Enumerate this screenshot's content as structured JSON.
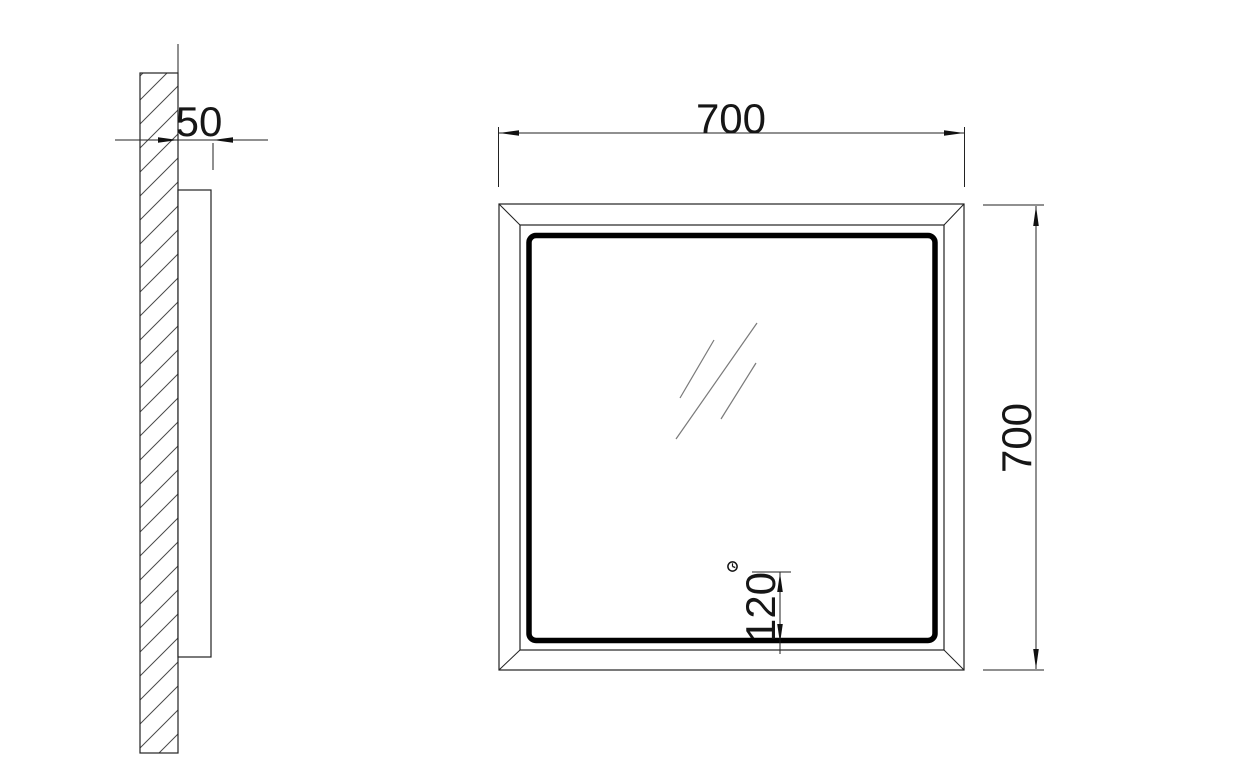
{
  "drawing": {
    "side_view": {
      "depth_dim_label": "50"
    },
    "front_view": {
      "width_dim_label": "700",
      "height_dim_label": "700",
      "sensor_offset_dim_label": "120"
    },
    "colors": {
      "line": "#222222",
      "led_band": "#000000",
      "reflection": "#7a7a7a",
      "background": "#ffffff"
    }
  }
}
